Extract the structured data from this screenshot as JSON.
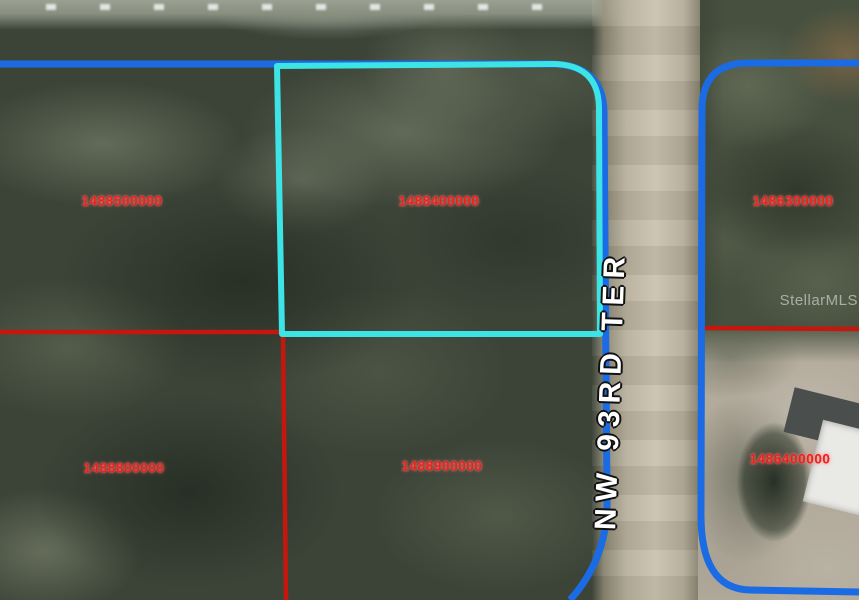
{
  "map": {
    "street_label": "NW 93RD TER",
    "watermark": "StellarMLS",
    "parcels": [
      {
        "id": "1488500000",
        "area": "top-left",
        "highlighted": false
      },
      {
        "id": "1488400000",
        "area": "top-center",
        "highlighted": true
      },
      {
        "id": "1486300000",
        "area": "top-right",
        "highlighted": false
      },
      {
        "id": "1488800000",
        "area": "bottom-left",
        "highlighted": false
      },
      {
        "id": "1488900000",
        "area": "bottom-center",
        "highlighted": false
      },
      {
        "id": "1486400000",
        "area": "bottom-right",
        "highlighted": false
      }
    ],
    "colors": {
      "boundary_blue": "#1a6be4",
      "highlight_cyan": "#3ce4e6",
      "boundary_red": "#c5170e",
      "parcel_label_red": "#e8231b",
      "street_label": "#ffffff",
      "road_tan": "#c2b9a7"
    }
  }
}
